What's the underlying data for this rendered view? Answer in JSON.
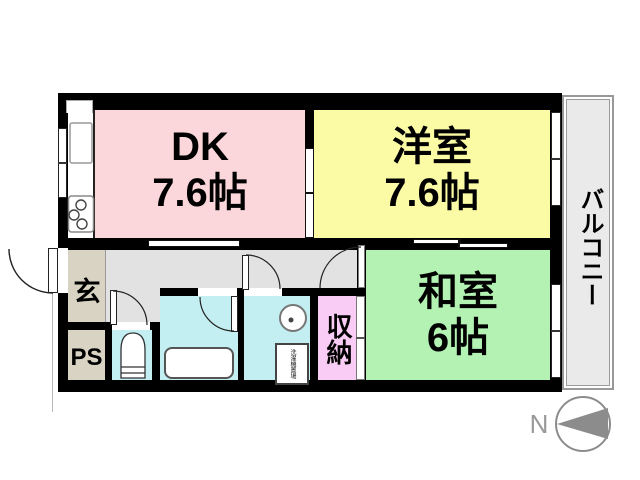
{
  "rooms": {
    "dk": {
      "name": "DK",
      "area": "7.6帖"
    },
    "western_room": {
      "name": "洋室",
      "area": "7.6帖"
    },
    "japanese_room": {
      "name": "和室",
      "area": "6帖"
    },
    "entrance": {
      "name": "玄"
    },
    "pipe_space": {
      "name": "PS"
    },
    "storage": {
      "name": "収納"
    },
    "balcony": {
      "name": "バルコニー"
    },
    "laundry_space": {
      "name": "洗濯機置場"
    }
  },
  "compass": {
    "north_label": "N"
  },
  "colors": {
    "dk": "#FBD7DB",
    "western_room": "#FBFBA6",
    "japanese_room": "#B4F2B4",
    "wet_area": "#C3EFF2",
    "storage": "#F8CCF4",
    "entrance_ps": "#D8D3C3",
    "hallway": "#E2E2E2",
    "balcony": "#EAEAEA",
    "wall": "#000000",
    "compass": "#8C8C8C"
  }
}
